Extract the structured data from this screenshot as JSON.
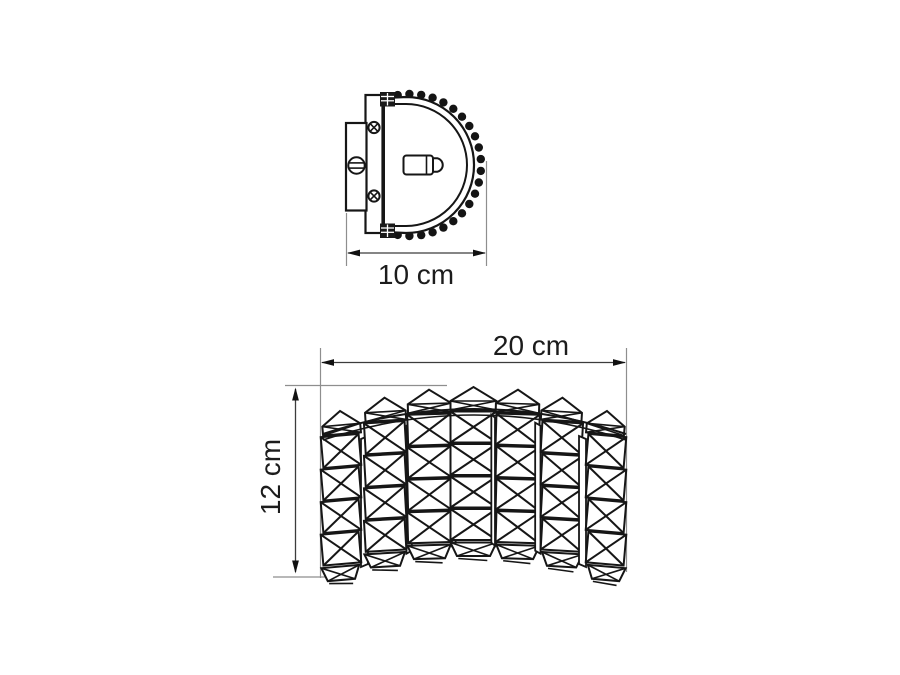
{
  "page": {
    "width": 900,
    "height": 675,
    "background": "#ffffff"
  },
  "figure": {
    "type": "technical-dimension-drawing",
    "subject": "crystal wall sconce",
    "views": {
      "side_view": {
        "title": "side profile view",
        "rim_bead_count": 22,
        "parts": [
          "wall plate",
          "slotted screw",
          "mounting bracket",
          "phillips screw",
          "clamp",
          "shade rim",
          "bead trim",
          "lamp socket"
        ],
        "dimension": {
          "label": "10 cm",
          "measures": "depth"
        }
      },
      "front_view": {
        "title": "front view",
        "crystal_columns": 7,
        "crystal_rows": 4,
        "width_dimension": {
          "label": "20 cm"
        },
        "height_dimension": {
          "label": "12 cm"
        }
      }
    },
    "colors": {
      "line": "#161616",
      "dimension_line": "#3c3c3c",
      "extension_line": "#8e8e8e",
      "label_text": "#1c1c1c",
      "background": "#ffffff"
    }
  }
}
